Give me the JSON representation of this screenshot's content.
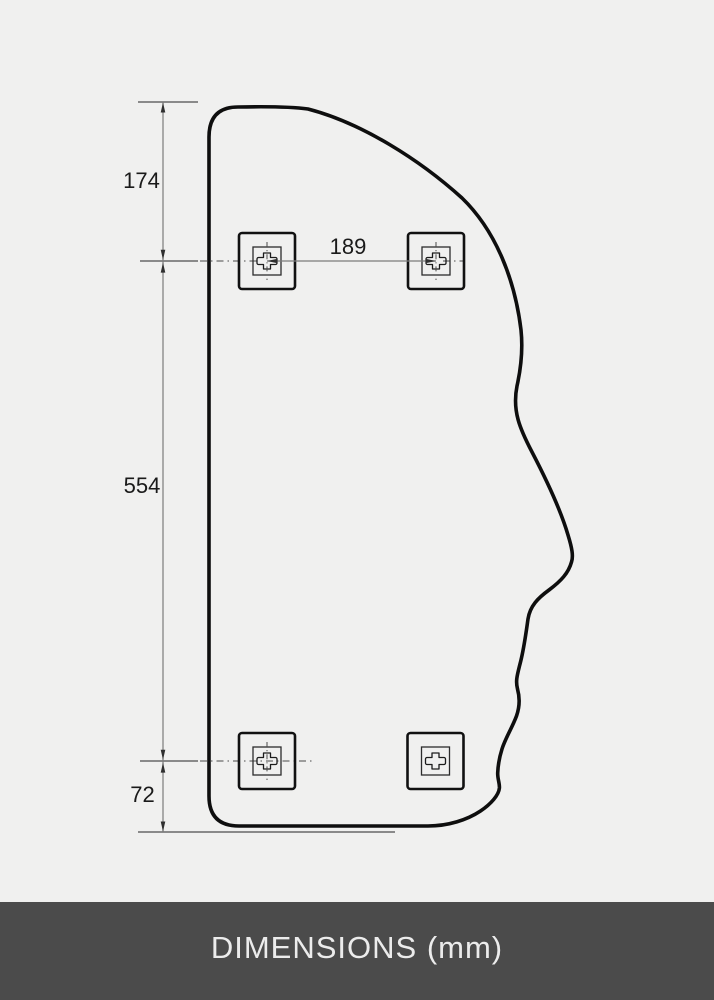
{
  "drawing": {
    "labels": {
      "top_offset_mm": "174",
      "body_height_mm": "554",
      "bottom_offset_mm": "72",
      "bracket_spacing_mm": "189"
    },
    "icons": {
      "mounting_bracket": "plus-in-square-icon"
    },
    "bracket_count": 4
  },
  "footer": {
    "label": "DIMENSIONS (mm)"
  },
  "colors": {
    "background": "#f0f0ef",
    "outline": "#0e0e0e",
    "dim_line": "#7b7b7b",
    "dim_text": "#1a1a1a",
    "arrow": "#2f2f2f",
    "bracket": "#111111",
    "footer_bg": "#4b4b4b",
    "footer_text": "#ececec"
  }
}
